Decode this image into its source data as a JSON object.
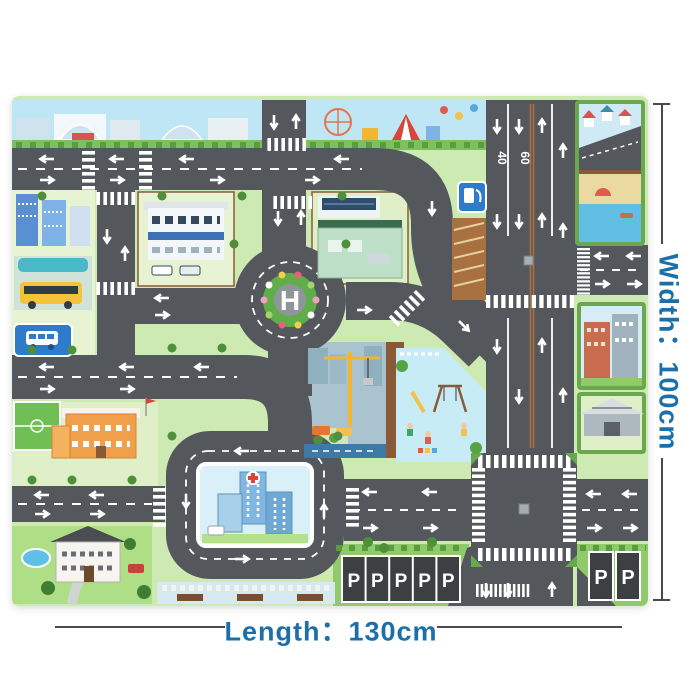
{
  "annotation": {
    "width_label": "Width：100cm",
    "length_label": "Length：130cm",
    "label_color": "#1d6fa9",
    "line_color": "#4a4a4a"
  },
  "mat": {
    "markings": {
      "helipad_letter": "H",
      "speed_limit_left": "40",
      "speed_limit_right": "60",
      "parking_row": [
        "P",
        "P",
        "P",
        "P",
        "P"
      ],
      "parking_corner": [
        "P",
        "P"
      ]
    },
    "colors": {
      "road": "#54585c",
      "grass": "#cdeab2",
      "sky": "#bee6f4",
      "hedge": "#61a144",
      "dirt": "#8a5a36",
      "water": "#5fc0e6",
      "sign_blue": "#2e7cc9",
      "crane_yellow": "#f2b632"
    },
    "scenes": [
      "city-skyline",
      "amusement-park",
      "residential-lake",
      "bus-station",
      "police-station",
      "gas-station",
      "construction-site",
      "playground",
      "hospital",
      "school",
      "mansion",
      "townhouses",
      "warehouse",
      "parking-lot",
      "helipad-roundabout",
      "highway"
    ]
  }
}
